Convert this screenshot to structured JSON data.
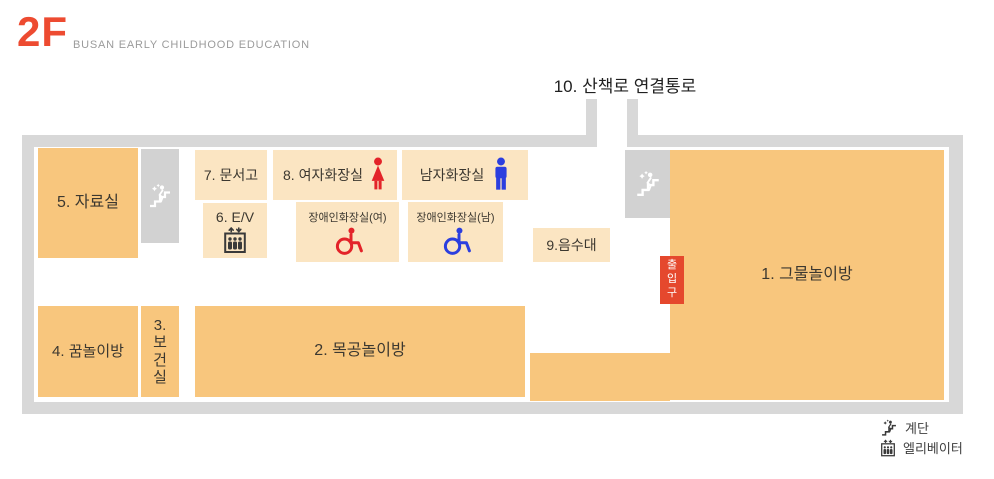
{
  "header": {
    "floor": "2F",
    "subtitle": "BUSAN EARLY CHILDHOOD EDUCATION"
  },
  "corridor_label": "10. 산책로 연결통로",
  "rooms": {
    "r1": "1. 그물놀이방",
    "r2": "2. 목공놀이방",
    "r3": "3.보건실",
    "r4": "4. 꿈놀이방",
    "r5": "5. 자료실",
    "r6": "6. E/V",
    "r7": "7. 문서고",
    "r8": "8. 여자화장실",
    "mens": "남자화장실",
    "disabled_w": "장애인화장실(여)",
    "disabled_m": "장애인화장실(남)",
    "fountain": "9.음수대"
  },
  "entrance": "출입구",
  "legend": {
    "stairs": "계단",
    "elevator": "엘리베이터"
  },
  "icons": {
    "stairs-icon": "person climbing steps",
    "elevator-icon": "elevator cabin with up/down arrows and passengers",
    "woman-icon": "female restroom pictogram",
    "man-icon": "male restroom pictogram",
    "wheelchair-icon": "wheelchair accessibility symbol"
  },
  "colors": {
    "brand_red": "#ED4B31",
    "entrance_red": "#E5482D",
    "icon_red": "#E32329",
    "icon_blue": "#2B3EDF",
    "room_dark": "#F8C67D",
    "room_light": "#FBE5C2",
    "wall_gray": "#D8D8D8",
    "stairs_gray": "#D2D2D2",
    "text_dark": "#3C3830",
    "subtitle_gray": "#9B9B9B"
  }
}
